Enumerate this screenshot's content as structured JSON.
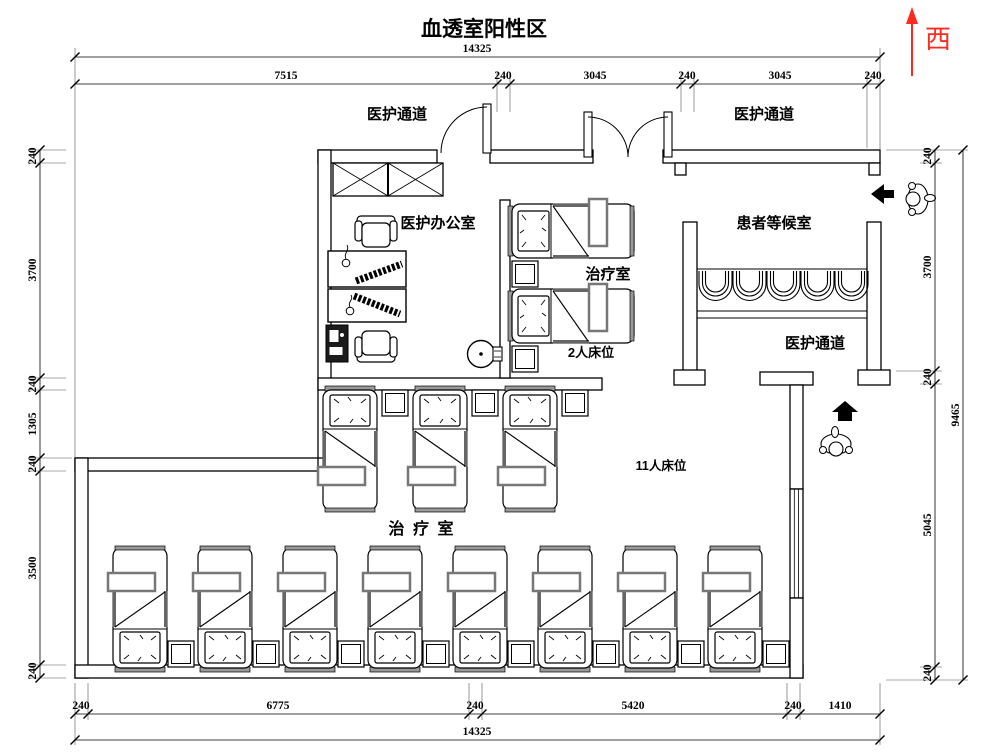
{
  "title": "血透室阳性区",
  "compass": {
    "label": "西",
    "color": "#ff2a1e"
  },
  "rooms": {
    "corridor_top_left": "医护通道",
    "corridor_top_right": "医护通道",
    "corridor_right": "医护通道",
    "office": "医护办公室",
    "treatment_small": "治疗室",
    "beds_2": "2人床位",
    "waiting": "患者等候室",
    "beds_11": "11人床位",
    "treatment_large": "治 疗 室"
  },
  "dims": {
    "top_total": "14325",
    "top_segments": [
      "7515",
      "240",
      "3045",
      "240",
      "3045",
      "240"
    ],
    "left_segments": [
      "240",
      "3700",
      "240",
      "1305",
      "240",
      "3500",
      "240"
    ],
    "right_segments": [
      "240",
      "3700",
      "240",
      "5045",
      "240"
    ],
    "right_total": "9465",
    "bottom_segments": [
      "240",
      "6775",
      "240",
      "5420",
      "240",
      "1410"
    ],
    "bottom_total": "14325"
  }
}
